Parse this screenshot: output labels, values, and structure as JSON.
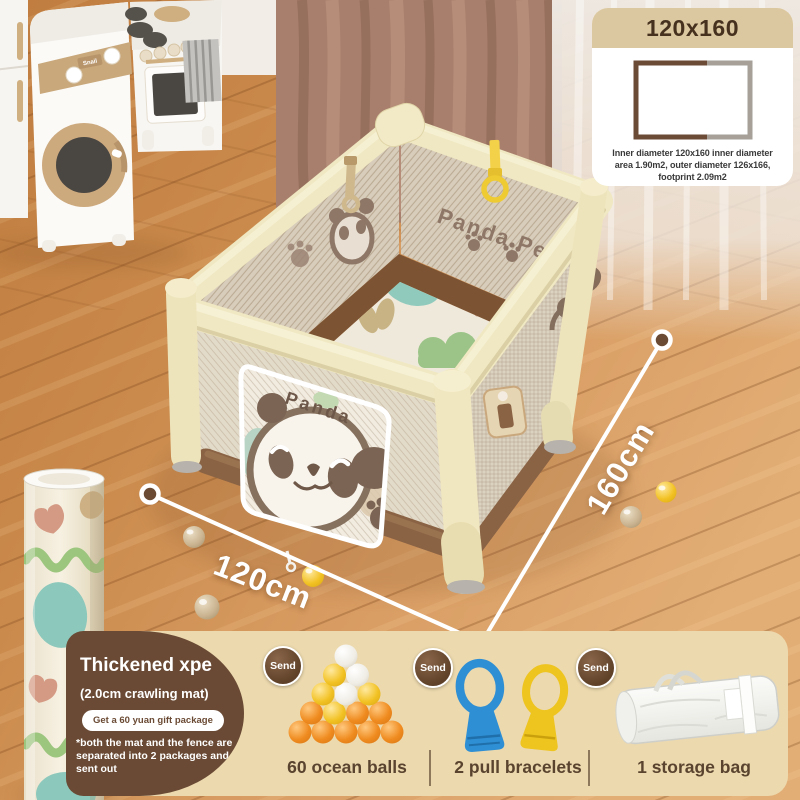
{
  "info_card": {
    "title": "120x160",
    "caption_line1": "Inner diameter 120x160 inner diameter",
    "caption_line2": "area 1.90m2, outer diameter 126x166,",
    "caption_line3": "footprint 2.09m2"
  },
  "dimensions": {
    "width_label": "120cm",
    "depth_label": "160cm"
  },
  "pen_graphics": {
    "back_wall_text": "Panda Pen",
    "door_text": "Panda",
    "washer_label": "Snail"
  },
  "promo": {
    "title": "Thickened xpe",
    "subtitle": "(2.0cm crawling mat)",
    "badge": "Get a 60 yuan gift package",
    "note": "*both the mat and the fence are separated into 2 packages and sent out"
  },
  "gifts": {
    "send_label": "Send",
    "items": [
      {
        "label": "60 ocean balls"
      },
      {
        "label": "2 pull bracelets"
      },
      {
        "label": "1 storage bag"
      }
    ]
  },
  "colors": {
    "accent_brown": "#6a4a34",
    "panel_tan": "#ecd9ae",
    "pen_cream": "#f0e8c2",
    "ring_yellow": "#f3d24a",
    "ring_blue": "#2f8fd4"
  }
}
